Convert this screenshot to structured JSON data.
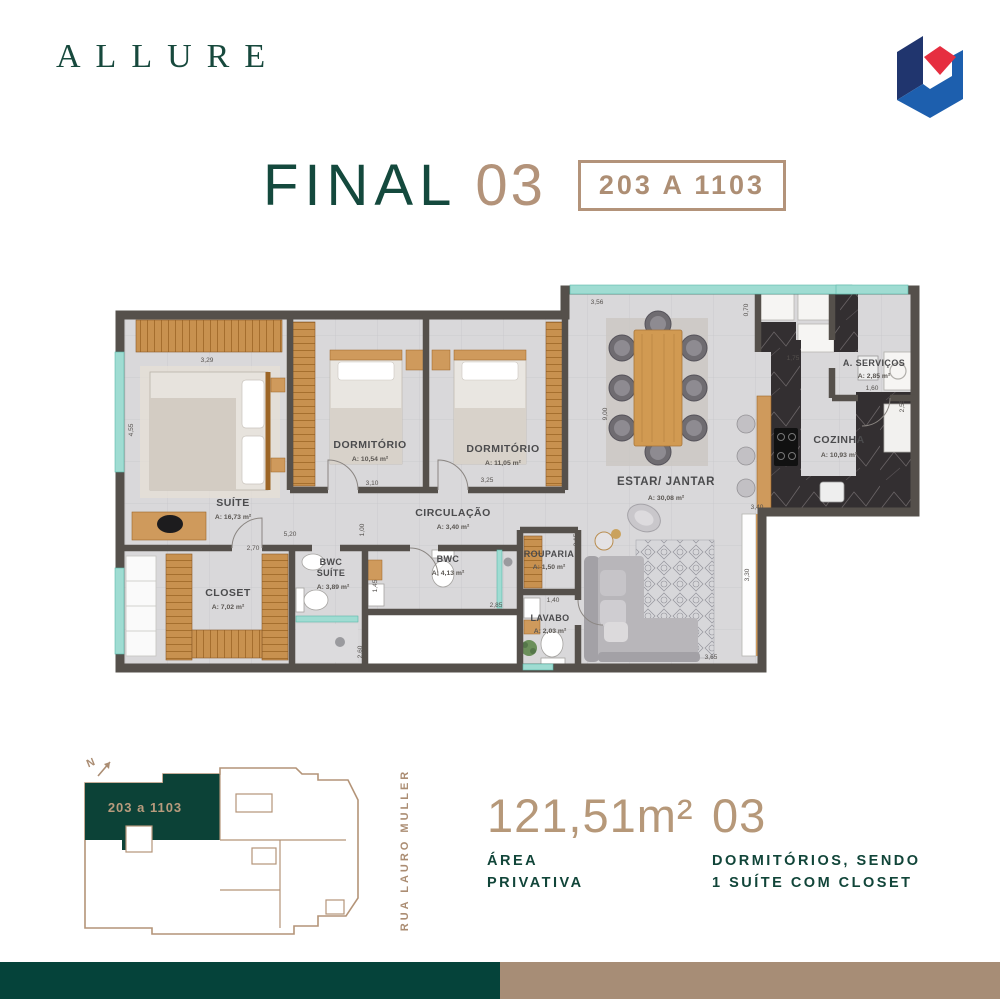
{
  "header": {
    "logo_text": "ALLURE"
  },
  "logo_mark": {
    "navy": "#20356e",
    "blue": "#1d5fae",
    "red": "#e62e40"
  },
  "title": {
    "main": "FINAL",
    "number": "03",
    "badge": "203 A 1103"
  },
  "floorplan": {
    "rooms": [
      {
        "name": "SUÍTE",
        "area": "A: 16,73 m²"
      },
      {
        "name": "DORMITÓRIO",
        "area": "A: 10,54 m²"
      },
      {
        "name": "DORMITÓRIO",
        "area": "A: 11,05 m²"
      },
      {
        "name": "CIRCULAÇÃO",
        "area": "A: 3,40 m²"
      },
      {
        "name": "BWC",
        "name2": "SUÍTE",
        "area": "A: 3,89 m²"
      },
      {
        "name": "BWC",
        "area": "A: 4,13 m²"
      },
      {
        "name": "CLOSET",
        "area": "A: 7,02 m²"
      },
      {
        "name": "ROUPARIA",
        "area": "A: 1,50 m²"
      },
      {
        "name": "LAVABO",
        "area": "A: 2,03 m²"
      },
      {
        "name": "ESTAR/ JANTAR",
        "area": "A: 30,08 m²"
      },
      {
        "name": "COZINHA",
        "area": "A: 10,93 m²"
      },
      {
        "name": "A. SERVIÇOS",
        "area": "A: 2,85 m²"
      }
    ],
    "dims": [
      "3,29",
      "4,55",
      "3,10",
      "3,25",
      "3,56",
      "0,70",
      "1,75",
      "1,60",
      "2,55",
      "9,00",
      "5,20",
      "2,70",
      "1,00",
      "1,45",
      "2,60",
      "2,85",
      "1,40",
      "2,15",
      "3,30",
      "3,40",
      "3,65"
    ]
  },
  "keyplan": {
    "north": "N",
    "unit_label": "203 a 1103",
    "street": "RUA LAURO MULLER"
  },
  "stats": {
    "area_value": "121,51m²",
    "area_label_line1": "ÁREA",
    "area_label_line2": "PRIVATIVA",
    "units_value": "03",
    "units_label_line1": "DORMITÓRIOS, SENDO",
    "units_label_line2": "1 SUÍTE COM CLOSET"
  },
  "colors": {
    "brand_green": "#14493d",
    "tan": "#ad8e74",
    "footer_green": "#05433a",
    "footer_tan": "#a78d76",
    "wall": "#55504b",
    "wood": "#cf9a5c",
    "window_teal": "#9fdcd2",
    "floor": "#d9d8da"
  }
}
